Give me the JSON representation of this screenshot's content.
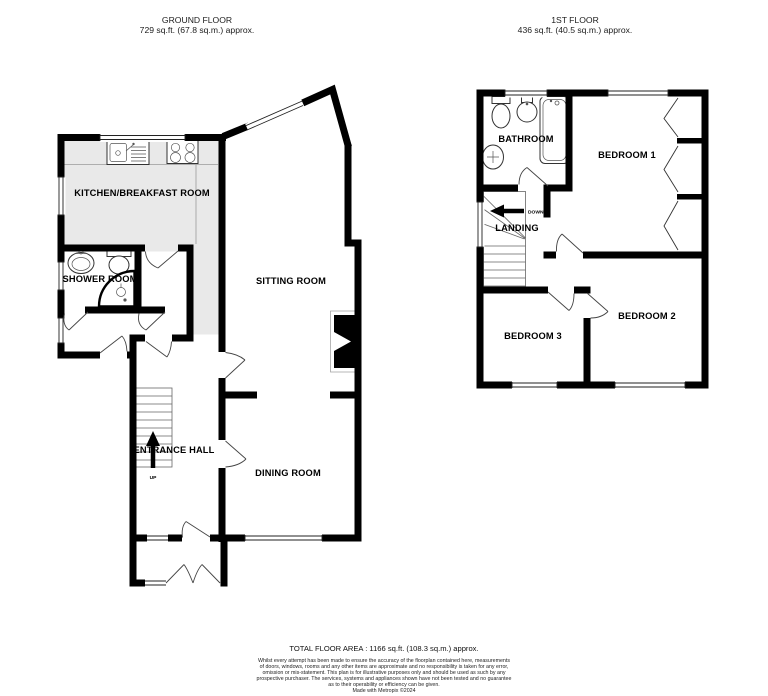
{
  "header": {
    "ground": {
      "title": "GROUND FLOOR",
      "area": "729 sq.ft. (67.8 sq.m.) approx."
    },
    "first": {
      "title": "1ST FLOOR",
      "area": "436 sq.ft. (40.5 sq.m.) approx."
    }
  },
  "ground_floor": {
    "kitchen": "KITCHEN/BREAKFAST ROOM",
    "shower_room": "SHOWER ROOM",
    "sitting_room": "SITTING ROOM",
    "entrance_hall": "ENTRANCE HALL",
    "dining_room": "DINING ROOM",
    "up": "UP"
  },
  "first_floor": {
    "bathroom": "BATHROOM",
    "landing": "LANDING",
    "bedroom1": "BEDROOM 1",
    "bedroom2": "BEDROOM 2",
    "bedroom3": "BEDROOM 3",
    "down": "DOWN"
  },
  "footer": {
    "total": "TOTAL FLOOR AREA : 1166 sq.ft. (108.3 sq.m.) approx.",
    "disclaimer": [
      "Whilst every attempt has been made to ensure the accuracy of the floorplan contained here, measurements",
      "of doors, windows, rooms and any other items are approximate and no responsibility is taken for any error,",
      "omission or mis-statement. This plan is for illustrative purposes only and should be used as such by any",
      "prospective purchaser. The services, systems and appliances shown have not been tested and no guarantee",
      "as to their operability or efficiency can be given.",
      "Made with Metropix ©2024"
    ]
  },
  "colors": {
    "wall": "#000000",
    "kitchen_fill": "#e9e9e9",
    "background": "#ffffff"
  }
}
